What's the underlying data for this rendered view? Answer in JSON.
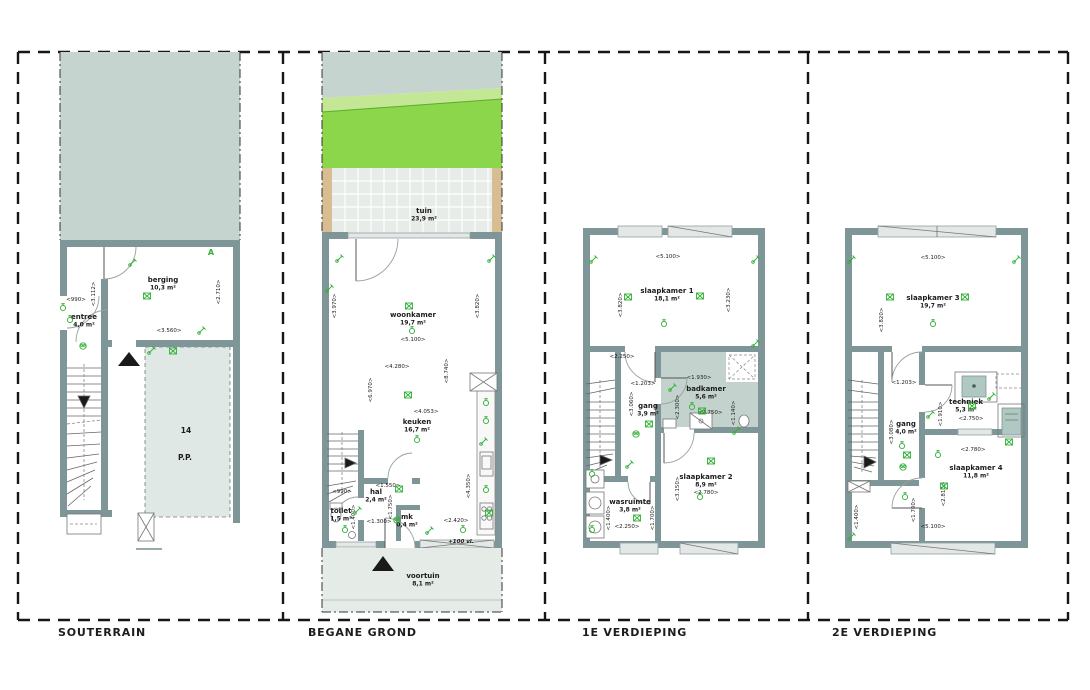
{
  "document": {
    "type": "architectural floor plan sheet",
    "language": "nl"
  },
  "colors": {
    "wall": "#7E9697",
    "ground": "#C6D4D0",
    "parking": "#DFE8E4",
    "terrace": "#E7ECE8",
    "fence": "#D8BC92",
    "grass_bright": "#8CD64B",
    "grass_light": "#C3E795",
    "front_garden": "#E5ECE8",
    "bathroom_floor": "#C3D2CD",
    "appliance": "#AFC8C2",
    "annotation_green": "#2FB134",
    "frame": "#161616"
  },
  "panels": [
    {
      "title": "SOUTERRAIN",
      "rooms": [
        {
          "name": "berging",
          "area": "10,3 m²",
          "x": 163,
          "y": 282
        },
        {
          "name": "entree",
          "area": "4,0 m²",
          "x": 84,
          "y": 319
        }
      ],
      "dims": [
        {
          "t": "<990>",
          "x": 76,
          "y": 301
        },
        {
          "t": "<3.112>",
          "x": 95,
          "y": 294,
          "v": 1
        },
        {
          "t": "<2.710>",
          "x": 220,
          "y": 292,
          "v": 1
        },
        {
          "t": "<3.560>",
          "x": 169,
          "y": 332
        }
      ],
      "notes": [
        {
          "t": "A",
          "x": 211,
          "y": 255,
          "c": "grn"
        },
        {
          "t": "14",
          "x": 186,
          "y": 433,
          "c": "big"
        },
        {
          "t": "P.P.",
          "x": 185,
          "y": 460,
          "c": "big"
        }
      ],
      "symbols": [
        [
          "b",
          147,
          296
        ],
        [
          "c",
          83,
          346
        ],
        [
          "s",
          70,
          320
        ],
        [
          "w",
          152,
          350
        ],
        [
          "b",
          173,
          351
        ],
        [
          "w",
          202,
          330
        ],
        [
          "w",
          133,
          262
        ],
        [
          "s",
          63,
          308
        ]
      ]
    },
    {
      "title": "BEGANE GROND",
      "rooms": [
        {
          "name": "tuin",
          "area": "23,9 m²",
          "x": 424,
          "y": 213
        },
        {
          "name": "woonkamer",
          "area": "19,7 m²",
          "x": 413,
          "y": 317
        },
        {
          "name": "keuken",
          "area": "16,7 m²",
          "x": 417,
          "y": 424
        },
        {
          "name": "hal",
          "area": "2,4 m²",
          "x": 376,
          "y": 494
        },
        {
          "name": "toilet",
          "area": "1,5 m²",
          "x": 341,
          "y": 513
        },
        {
          "name": "mk",
          "area": "0,4 m²",
          "x": 407,
          "y": 519
        },
        {
          "name": "voortuin",
          "area": "8,1 m²",
          "x": 423,
          "y": 578
        }
      ],
      "dims": [
        {
          "t": "<5.100>",
          "x": 413,
          "y": 341
        },
        {
          "t": "<3.970>",
          "x": 336,
          "y": 306,
          "v": 1
        },
        {
          "t": "<3.820>",
          "x": 479,
          "y": 306,
          "v": 1
        },
        {
          "t": "<4.280>",
          "x": 397,
          "y": 368
        },
        {
          "t": "<6.970>",
          "x": 372,
          "y": 390,
          "v": 1
        },
        {
          "t": "<8.740>",
          "x": 448,
          "y": 371,
          "v": 1
        },
        {
          "t": "<4.053>",
          "x": 426,
          "y": 413
        },
        {
          "t": "<4.350>",
          "x": 470,
          "y": 486,
          "v": 1
        },
        {
          "t": "<2.420>",
          "x": 456,
          "y": 522
        },
        {
          "t": "<1.550>",
          "x": 388,
          "y": 487
        },
        {
          "t": "<1.750>",
          "x": 392,
          "y": 507,
          "v": 1
        },
        {
          "t": "<990>",
          "x": 342,
          "y": 493
        },
        {
          "t": "<1.400>",
          "x": 355,
          "y": 517,
          "v": 1
        },
        {
          "t": "<1.300>",
          "x": 379,
          "y": 523
        }
      ],
      "notes": [
        {
          "t": "+100 vl.",
          "x": 461,
          "y": 543,
          "c": "si"
        }
      ],
      "symbols": [
        [
          "b",
          409,
          306
        ],
        [
          "s",
          412,
          331
        ],
        [
          "w",
          330,
          288
        ],
        [
          "w",
          492,
          258
        ],
        [
          "w",
          340,
          258
        ],
        [
          "b",
          408,
          395
        ],
        [
          "s",
          417,
          440
        ],
        [
          "s",
          486,
          403
        ],
        [
          "s",
          486,
          421
        ],
        [
          "w",
          484,
          441
        ],
        [
          "s",
          486,
          490
        ],
        [
          "b",
          489,
          513
        ],
        [
          "b",
          399,
          489
        ],
        [
          "s",
          345,
          530
        ],
        [
          "w",
          358,
          510
        ],
        [
          "c",
          397,
          520
        ],
        [
          "w",
          430,
          530
        ],
        [
          "s",
          463,
          530
        ]
      ]
    },
    {
      "title": "1E VERDIEPING",
      "rooms": [
        {
          "name": "slaapkamer 1",
          "area": "18,1 m²",
          "x": 667,
          "y": 293
        },
        {
          "name": "badkamer",
          "area": "5,6 m²",
          "x": 706,
          "y": 391
        },
        {
          "name": "gang",
          "area": "3,9 m²",
          "x": 648,
          "y": 408
        },
        {
          "name": "slaapkamer 2",
          "area": "8,9 m²",
          "x": 706,
          "y": 479
        },
        {
          "name": "wasruimte",
          "area": "3,8 m²",
          "x": 630,
          "y": 504
        }
      ],
      "dims": [
        {
          "t": "<5.100>",
          "x": 668,
          "y": 258
        },
        {
          "t": "<3.820>",
          "x": 622,
          "y": 305,
          "v": 1
        },
        {
          "t": "<3.230>",
          "x": 730,
          "y": 300,
          "v": 1
        },
        {
          "t": "<2.250>",
          "x": 622,
          "y": 358
        },
        {
          "t": "<1.203>",
          "x": 643,
          "y": 385
        },
        {
          "t": "<1.930>",
          "x": 699,
          "y": 379
        },
        {
          "t": "<2.750>",
          "x": 710,
          "y": 414
        },
        {
          "t": "<2.300>",
          "x": 679,
          "y": 407,
          "v": 1
        },
        {
          "t": "<1.140>",
          "x": 735,
          "y": 413,
          "v": 1
        },
        {
          "t": "<3.060>",
          "x": 633,
          "y": 404,
          "v": 1
        },
        {
          "t": "<2.780>",
          "x": 706,
          "y": 494
        },
        {
          "t": "<3.150>",
          "x": 679,
          "y": 489,
          "v": 1
        },
        {
          "t": "<1.400>",
          "x": 610,
          "y": 518,
          "v": 1
        },
        {
          "t": "<1.700>",
          "x": 654,
          "y": 518,
          "v": 1
        },
        {
          "t": "<2.250>",
          "x": 627,
          "y": 528
        }
      ],
      "notes": [],
      "symbols": [
        [
          "w",
          594,
          259
        ],
        [
          "w",
          756,
          259
        ],
        [
          "b",
          628,
          297
        ],
        [
          "b",
          700,
          296
        ],
        [
          "s",
          664,
          324
        ],
        [
          "w",
          756,
          343
        ],
        [
          "b",
          649,
          424
        ],
        [
          "c",
          636,
          434
        ],
        [
          "w",
          673,
          387
        ],
        [
          "s",
          692,
          407
        ],
        [
          "b",
          702,
          411
        ],
        [
          "w",
          737,
          430
        ],
        [
          "b",
          711,
          461
        ],
        [
          "s",
          700,
          497
        ],
        [
          "b",
          637,
          518
        ],
        [
          "s",
          592,
          474
        ],
        [
          "w",
          630,
          464
        ],
        [
          "s",
          592,
          530
        ]
      ]
    },
    {
      "title": "2E VERDIEPING",
      "rooms": [
        {
          "name": "slaapkamer 3",
          "area": "19,7 m²",
          "x": 933,
          "y": 300
        },
        {
          "name": "techniek",
          "area": "5,3 m²",
          "x": 966,
          "y": 404
        },
        {
          "name": "gang",
          "area": "4,0 m²",
          "x": 906,
          "y": 426
        },
        {
          "name": "slaapkamer 4",
          "area": "11,8 m²",
          "x": 976,
          "y": 470
        }
      ],
      "dims": [
        {
          "t": "<5.100>",
          "x": 933,
          "y": 259
        },
        {
          "t": "<3.820>",
          "x": 883,
          "y": 320,
          "v": 1
        },
        {
          "t": "<1.203>",
          "x": 904,
          "y": 384
        },
        {
          "t": "<2.750>",
          "x": 971,
          "y": 420
        },
        {
          "t": "<1.910>",
          "x": 942,
          "y": 414,
          "v": 1
        },
        {
          "t": "<3.080>",
          "x": 893,
          "y": 432,
          "v": 1
        },
        {
          "t": "<2.780>",
          "x": 973,
          "y": 451
        },
        {
          "t": "<2.810>",
          "x": 945,
          "y": 494,
          "v": 1
        },
        {
          "t": "<1.700>",
          "x": 915,
          "y": 510,
          "v": 1
        },
        {
          "t": "<5.100>",
          "x": 933,
          "y": 528
        },
        {
          "t": "<1.400>",
          "x": 858,
          "y": 517,
          "v": 1
        }
      ],
      "notes": [],
      "symbols": [
        [
          "w",
          852,
          259
        ],
        [
          "w",
          1017,
          259
        ],
        [
          "b",
          890,
          297
        ],
        [
          "b",
          965,
          297
        ],
        [
          "s",
          933,
          324
        ],
        [
          "s",
          902,
          446
        ],
        [
          "b",
          907,
          455
        ],
        [
          "c",
          903,
          467
        ],
        [
          "b",
          972,
          406
        ],
        [
          "w",
          931,
          414
        ],
        [
          "w",
          992,
          396
        ],
        [
          "b",
          944,
          486
        ],
        [
          "s",
          938,
          455
        ],
        [
          "w",
          852,
          536
        ],
        [
          "s",
          905,
          497
        ],
        [
          "b",
          1009,
          442
        ]
      ]
    }
  ]
}
